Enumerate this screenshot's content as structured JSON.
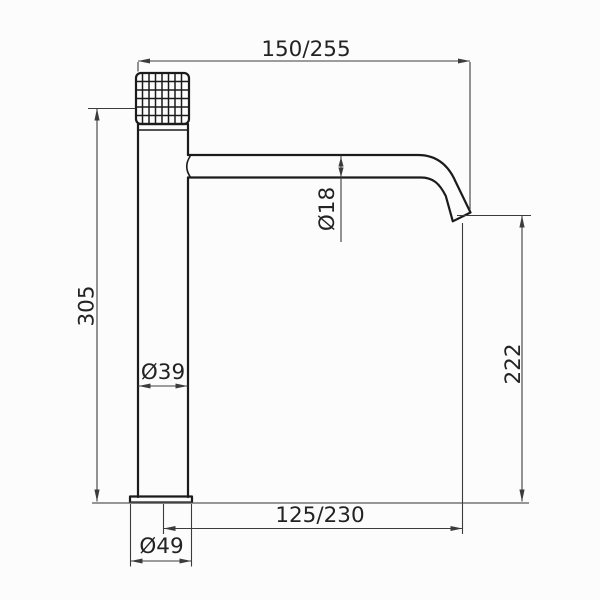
{
  "drawing": {
    "colors": {
      "background": "#fcfcfc",
      "outline": "#1b1b1b",
      "dimension": "#3c3c3c",
      "text": "#232323"
    },
    "dim_labels": {
      "total_reach": "150/255",
      "spout_diameter": "Ø18",
      "body_height": "305",
      "body_diameter": "Ø39",
      "spout_height": "222",
      "center_to_outlet": "125/230",
      "base_diameter": "Ø49"
    }
  }
}
